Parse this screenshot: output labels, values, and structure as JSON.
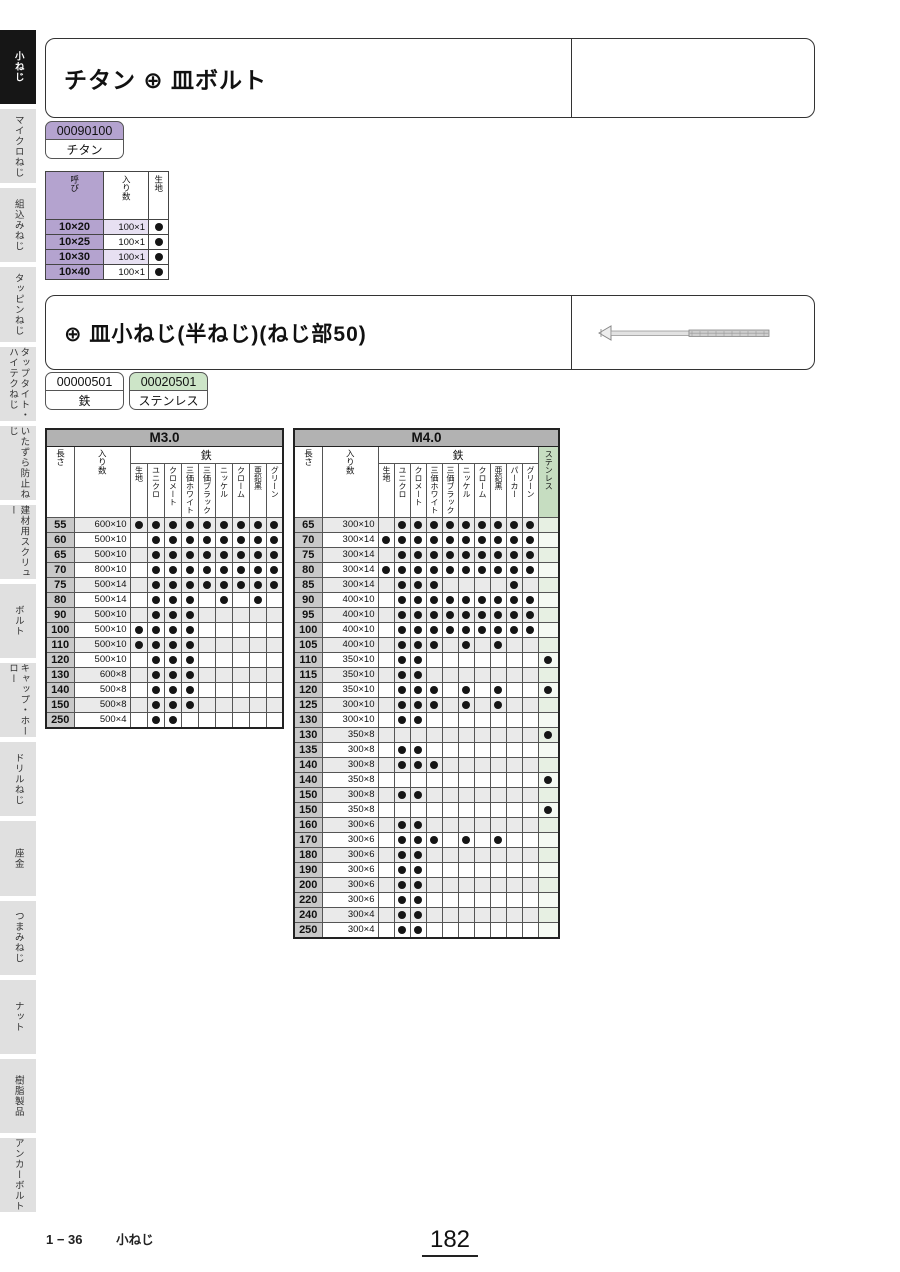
{
  "page": {
    "footer_code": "1 − 36",
    "footer_label": "小ねじ",
    "page_number": "182"
  },
  "sidebar": {
    "items": [
      {
        "label": "小ねじ",
        "active": true
      },
      {
        "label": "マイクロねじ",
        "active": false
      },
      {
        "label": "組込みねじ",
        "active": false
      },
      {
        "label": "タッピンねじ",
        "active": false
      },
      {
        "label": "タップタイト・ハイテクねじ",
        "active": false
      },
      {
        "label": "いたずら防止ねじ",
        "active": false
      },
      {
        "label": "建材用スクリュー",
        "active": false
      },
      {
        "label": "ボルト",
        "active": false
      },
      {
        "label": "キャップ・ホーロー",
        "active": false
      },
      {
        "label": "ドリルねじ",
        "active": false
      },
      {
        "label": "座金",
        "active": false
      },
      {
        "label": "つまみねじ",
        "active": false
      },
      {
        "label": "ナット",
        "active": false
      },
      {
        "label": "樹脂製品",
        "active": false
      },
      {
        "label": "アンカーボルト",
        "active": false
      }
    ]
  },
  "section_titanium": {
    "title": "チタン ⊕ 皿ボルト",
    "badge": {
      "code": "00090100",
      "material": "チタン",
      "color": "#b4a3cf"
    },
    "table": {
      "headers": {
        "call": "呼び",
        "qty": "入り数",
        "plain": "生地"
      },
      "rows": [
        {
          "call": "10×20",
          "qty": "100×1",
          "plain": 1
        },
        {
          "call": "10×25",
          "qty": "100×1",
          "plain": 1
        },
        {
          "call": "10×30",
          "qty": "100×1",
          "plain": 1
        },
        {
          "call": "10×40",
          "qty": "100×1",
          "plain": 1
        }
      ]
    }
  },
  "section_sara": {
    "title": "⊕ 皿小ねじ(半ねじ)(ねじ部50)",
    "badges": [
      {
        "code": "00000501",
        "material": "鉄",
        "color": "#ffffff"
      },
      {
        "code": "00020501",
        "material": "ステンレス",
        "color": "#cde5c8"
      }
    ],
    "product_image": "countersunk-screw-side-view"
  },
  "tables": [
    {
      "title": "M3.0",
      "len_label": "長さ",
      "qty_label": "入り数",
      "group_label": "鉄",
      "finishes": [
        "生地",
        "ユニクロ",
        "クロメート",
        "三価ホワイト",
        "三価ブラック",
        "ニッケル",
        "クローム",
        "亜鉛黒",
        "グリーン"
      ],
      "stainless": false,
      "rows": [
        {
          "len": "55",
          "qty": "600×10",
          "dots": [
            1,
            1,
            1,
            1,
            1,
            1,
            1,
            1,
            1
          ]
        },
        {
          "len": "60",
          "qty": "500×10",
          "dots": [
            0,
            1,
            1,
            1,
            1,
            1,
            1,
            1,
            1
          ]
        },
        {
          "len": "65",
          "qty": "500×10",
          "dots": [
            0,
            1,
            1,
            1,
            1,
            1,
            1,
            1,
            1
          ]
        },
        {
          "len": "70",
          "qty": "800×10",
          "dots": [
            0,
            1,
            1,
            1,
            1,
            1,
            1,
            1,
            1
          ]
        },
        {
          "len": "75",
          "qty": "500×14",
          "dots": [
            0,
            1,
            1,
            1,
            1,
            1,
            1,
            1,
            1
          ]
        },
        {
          "len": "80",
          "qty": "500×14",
          "dots": [
            0,
            1,
            1,
            1,
            0,
            1,
            0,
            1,
            0
          ]
        },
        {
          "len": "90",
          "qty": "500×10",
          "dots": [
            0,
            1,
            1,
            1,
            0,
            0,
            0,
            0,
            0
          ]
        },
        {
          "len": "100",
          "qty": "500×10",
          "dots": [
            1,
            1,
            1,
            1,
            0,
            0,
            0,
            0,
            0
          ]
        },
        {
          "len": "110",
          "qty": "500×10",
          "dots": [
            1,
            1,
            1,
            1,
            0,
            0,
            0,
            0,
            0
          ]
        },
        {
          "len": "120",
          "qty": "500×10",
          "dots": [
            0,
            1,
            1,
            1,
            0,
            0,
            0,
            0,
            0
          ]
        },
        {
          "len": "130",
          "qty": "600×8",
          "dots": [
            0,
            1,
            1,
            1,
            0,
            0,
            0,
            0,
            0
          ]
        },
        {
          "len": "140",
          "qty": "500×8",
          "dots": [
            0,
            1,
            1,
            1,
            0,
            0,
            0,
            0,
            0
          ]
        },
        {
          "len": "150",
          "qty": "500×8",
          "dots": [
            0,
            1,
            1,
            1,
            0,
            0,
            0,
            0,
            0
          ]
        },
        {
          "len": "250",
          "qty": "500×4",
          "dots": [
            0,
            1,
            1,
            0,
            0,
            0,
            0,
            0,
            0
          ]
        }
      ]
    },
    {
      "title": "M4.0",
      "len_label": "長さ",
      "qty_label": "入り数",
      "group_label": "鉄",
      "finishes": [
        "生地",
        "ユニクロ",
        "クロメート",
        "三価ホワイト",
        "三価ブラック",
        "ニッケル",
        "クローム",
        "亜鉛黒",
        "パーカー",
        "グリーン"
      ],
      "stainless": true,
      "stainless_label": "ステンレス",
      "rows": [
        {
          "len": "65",
          "qty": "300×10",
          "dots": [
            0,
            1,
            1,
            1,
            1,
            1,
            1,
            1,
            1,
            1
          ],
          "stn": 0
        },
        {
          "len": "70",
          "qty": "300×14",
          "dots": [
            1,
            1,
            1,
            1,
            1,
            1,
            1,
            1,
            1,
            1
          ],
          "stn": 0
        },
        {
          "len": "75",
          "qty": "300×14",
          "dots": [
            0,
            1,
            1,
            1,
            1,
            1,
            1,
            1,
            1,
            1
          ],
          "stn": 0
        },
        {
          "len": "80",
          "qty": "300×14",
          "dots": [
            1,
            1,
            1,
            1,
            1,
            1,
            1,
            1,
            1,
            1
          ],
          "stn": 0
        },
        {
          "len": "85",
          "qty": "300×14",
          "dots": [
            0,
            1,
            1,
            1,
            0,
            0,
            0,
            0,
            1,
            0
          ],
          "stn": 0
        },
        {
          "len": "90",
          "qty": "400×10",
          "dots": [
            0,
            1,
            1,
            1,
            1,
            1,
            1,
            1,
            1,
            1
          ],
          "stn": 0
        },
        {
          "len": "95",
          "qty": "400×10",
          "dots": [
            0,
            1,
            1,
            1,
            1,
            1,
            1,
            1,
            1,
            1
          ],
          "stn": 0
        },
        {
          "len": "100",
          "qty": "400×10",
          "dots": [
            0,
            1,
            1,
            1,
            1,
            1,
            1,
            1,
            1,
            1
          ],
          "stn": 0
        },
        {
          "len": "105",
          "qty": "400×10",
          "dots": [
            0,
            1,
            1,
            1,
            0,
            1,
            0,
            1,
            0,
            0
          ],
          "stn": 0
        },
        {
          "len": "110",
          "qty": "350×10",
          "dots": [
            0,
            1,
            1,
            0,
            0,
            0,
            0,
            0,
            0,
            0
          ],
          "stn": 1
        },
        {
          "len": "115",
          "qty": "350×10",
          "dots": [
            0,
            1,
            1,
            0,
            0,
            0,
            0,
            0,
            0,
            0
          ],
          "stn": 0
        },
        {
          "len": "120",
          "qty": "350×10",
          "dots": [
            0,
            1,
            1,
            1,
            0,
            1,
            0,
            1,
            0,
            0
          ],
          "stn": 1
        },
        {
          "len": "125",
          "qty": "300×10",
          "dots": [
            0,
            1,
            1,
            1,
            0,
            1,
            0,
            1,
            0,
            0
          ],
          "stn": 0
        },
        {
          "len": "130",
          "qty": "300×10",
          "dots": [
            0,
            1,
            1,
            0,
            0,
            0,
            0,
            0,
            0,
            0
          ],
          "stn": 0
        },
        {
          "len": "130",
          "qty": "350×8",
          "dots": [
            0,
            0,
            0,
            0,
            0,
            0,
            0,
            0,
            0,
            0
          ],
          "stn": 1
        },
        {
          "len": "135",
          "qty": "300×8",
          "dots": [
            0,
            1,
            1,
            0,
            0,
            0,
            0,
            0,
            0,
            0
          ],
          "stn": 0
        },
        {
          "len": "140",
          "qty": "300×8",
          "dots": [
            0,
            1,
            1,
            1,
            0,
            0,
            0,
            0,
            0,
            0
          ],
          "stn": 0
        },
        {
          "len": "140",
          "qty": "350×8",
          "dots": [
            0,
            0,
            0,
            0,
            0,
            0,
            0,
            0,
            0,
            0
          ],
          "stn": 1
        },
        {
          "len": "150",
          "qty": "300×8",
          "dots": [
            0,
            1,
            1,
            0,
            0,
            0,
            0,
            0,
            0,
            0
          ],
          "stn": 0
        },
        {
          "len": "150",
          "qty": "350×8",
          "dots": [
            0,
            0,
            0,
            0,
            0,
            0,
            0,
            0,
            0,
            0
          ],
          "stn": 1
        },
        {
          "len": "160",
          "qty": "300×6",
          "dots": [
            0,
            1,
            1,
            0,
            0,
            0,
            0,
            0,
            0,
            0
          ],
          "stn": 0
        },
        {
          "len": "170",
          "qty": "300×6",
          "dots": [
            0,
            1,
            1,
            1,
            0,
            1,
            0,
            1,
            0,
            0
          ],
          "stn": 0
        },
        {
          "len": "180",
          "qty": "300×6",
          "dots": [
            0,
            1,
            1,
            0,
            0,
            0,
            0,
            0,
            0,
            0
          ],
          "stn": 0
        },
        {
          "len": "190",
          "qty": "300×6",
          "dots": [
            0,
            1,
            1,
            0,
            0,
            0,
            0,
            0,
            0,
            0
          ],
          "stn": 0
        },
        {
          "len": "200",
          "qty": "300×6",
          "dots": [
            0,
            1,
            1,
            0,
            0,
            0,
            0,
            0,
            0,
            0
          ],
          "stn": 0
        },
        {
          "len": "220",
          "qty": "300×6",
          "dots": [
            0,
            1,
            1,
            0,
            0,
            0,
            0,
            0,
            0,
            0
          ],
          "stn": 0
        },
        {
          "len": "240",
          "qty": "300×4",
          "dots": [
            0,
            1,
            1,
            0,
            0,
            0,
            0,
            0,
            0,
            0
          ],
          "stn": 0
        },
        {
          "len": "250",
          "qty": "300×4",
          "dots": [
            0,
            1,
            1,
            0,
            0,
            0,
            0,
            0,
            0,
            0
          ],
          "stn": 0
        }
      ]
    }
  ],
  "colors": {
    "accent_purple": "#b4a3cf",
    "light_purple": "#e7e0f2",
    "badge_green": "#cde5c8",
    "header_green": "#c6ddc1",
    "cell_green": "#e7f0e3",
    "band_gray": "#b2b2b2",
    "row_gray": "#eaeaea",
    "len_gray": "#c8c8c8",
    "sidebar_active": "#161616",
    "dot_black": "#151515"
  }
}
